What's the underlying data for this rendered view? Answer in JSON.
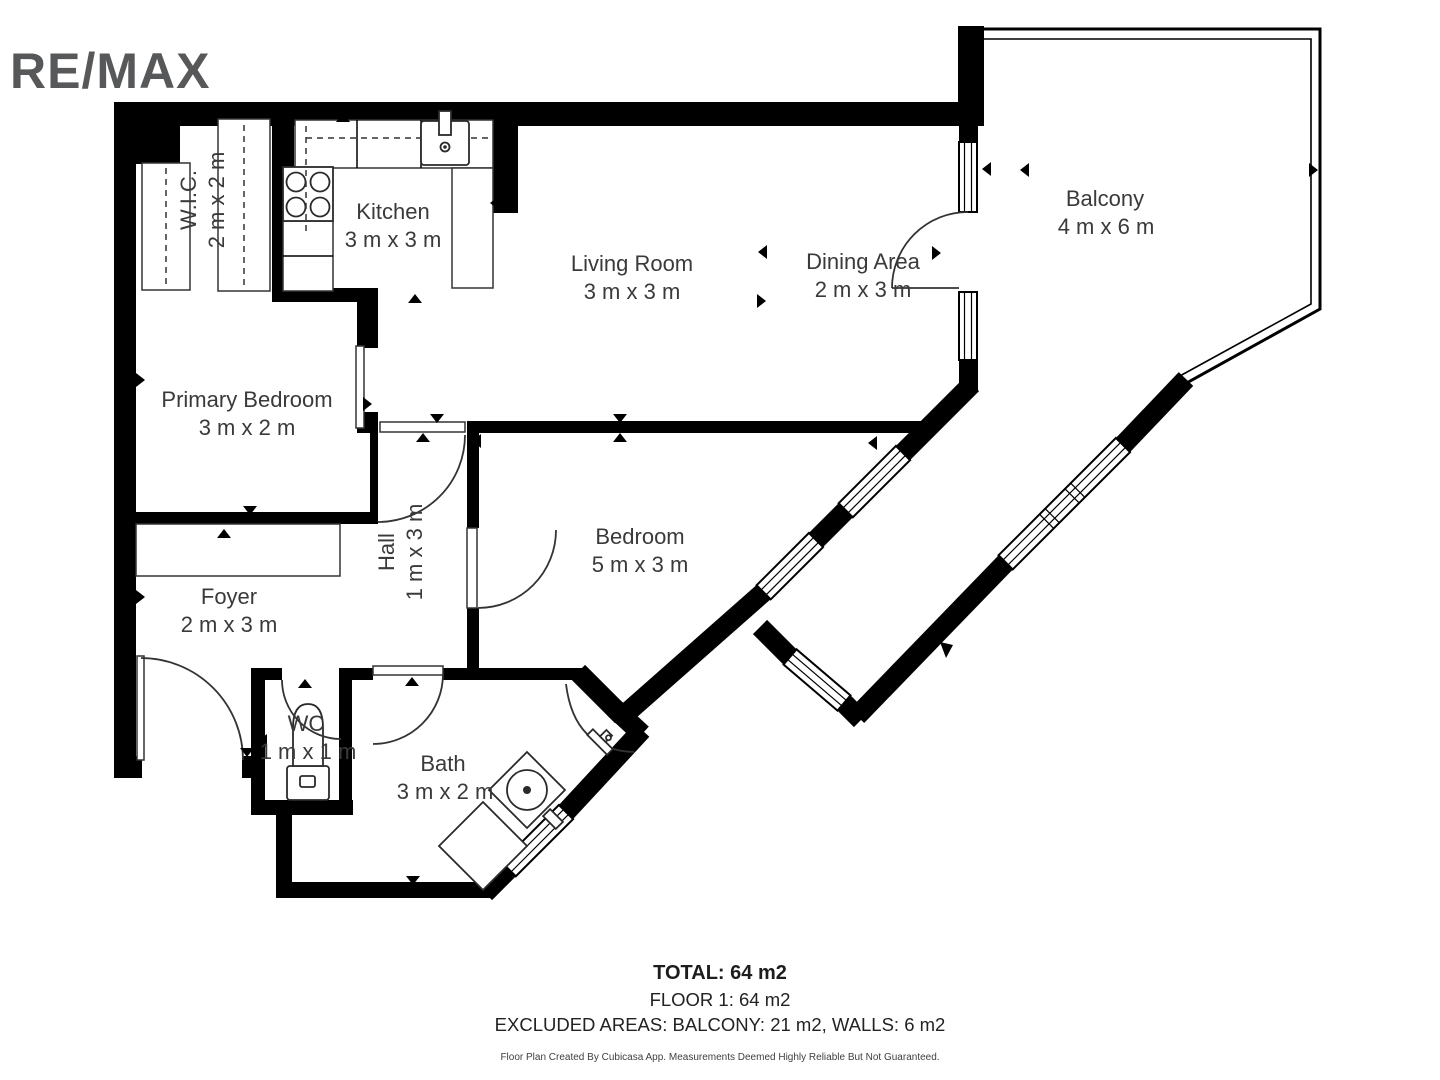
{
  "logo": {
    "text": "RE/MAX",
    "color": "#57585a"
  },
  "rooms": [
    {
      "id": "wic",
      "name": "W.I.C.",
      "dims": "2 m x 2 m"
    },
    {
      "id": "kitchen",
      "name": "Kitchen",
      "dims": "3 m x 3 m"
    },
    {
      "id": "living",
      "name": "Living Room",
      "dims": "3 m x 3 m"
    },
    {
      "id": "dining",
      "name": "Dining Area",
      "dims": "2 m x 3 m"
    },
    {
      "id": "balcony",
      "name": "Balcony",
      "dims": "4 m x 6 m"
    },
    {
      "id": "primary",
      "name": "Primary Bedroom",
      "dims": "3 m x 2 m"
    },
    {
      "id": "hall",
      "name": "Hall",
      "dims": "1 m x 3 m"
    },
    {
      "id": "bedroom",
      "name": "Bedroom",
      "dims": "5 m x 3 m"
    },
    {
      "id": "foyer",
      "name": "Foyer",
      "dims": "2 m x 3 m"
    },
    {
      "id": "wc",
      "name": "WC",
      "dims": "1 m x 1 m"
    },
    {
      "id": "bath",
      "name": "Bath",
      "dims": "3 m x 2 m"
    }
  ],
  "summary": {
    "total": "TOTAL: 64 m2",
    "floor": "FLOOR 1: 64 m2",
    "excluded": "EXCLUDED AREAS: BALCONY: 21 m2, WALLS: 6 m2",
    "disclaimer": "Floor Plan Created By Cubicasa App. Measurements Deemed Highly Reliable But Not Guaranteed."
  },
  "colors": {
    "wall": "#000000",
    "label": "#3a3a3a",
    "logo": "#57585a"
  }
}
